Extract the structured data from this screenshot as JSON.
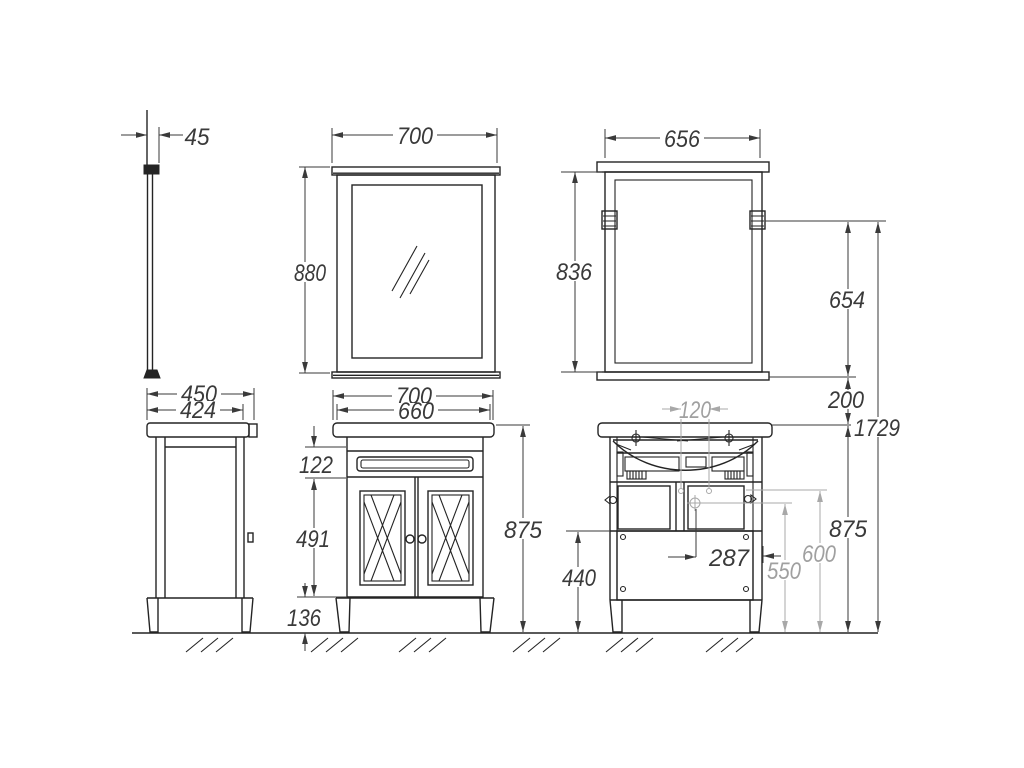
{
  "labels": {
    "mirror_depth": "45",
    "mirror_front_width": "700",
    "mirror_front_height": "880",
    "mirror_rear_width": "656",
    "mirror_rear_height": "836",
    "side_top_depth": "450",
    "side_body_depth": "424",
    "cab_top_width": "700",
    "cab_body_width": "660",
    "rail_height": "122",
    "door_height": "491",
    "leg_height": "136",
    "cab_height_front": "875",
    "inlet_spacing": "120",
    "drain_offset": "287",
    "panel_height": "440",
    "drain_height": "550",
    "hinge_height": "600",
    "cab_height_rear": "875",
    "mirror_height_span": "654",
    "mirror_gap": "200",
    "total_height": "1729"
  },
  "colors": {
    "line": "#242424",
    "dimension": "#3a3a3a",
    "secondary": "#a8a8a8",
    "background": "#ffffff"
  }
}
